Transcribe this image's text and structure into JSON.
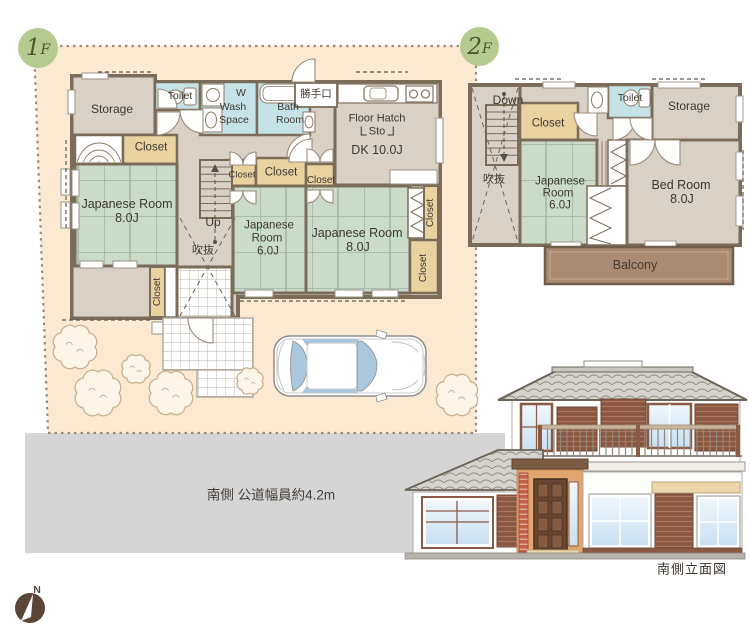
{
  "floor1": {
    "badge_num": "1",
    "badge_suffix": "F",
    "storage": "Storage",
    "toilet": "Toilet",
    "wash_l1": "W",
    "wash_l2": "Wash",
    "wash_l3": "Space",
    "bath_l1": "Bath",
    "bath_l2": "Room",
    "back_door": "勝手口",
    "floor_hatch_l1": "Floor Hatch",
    "floor_hatch_l2": "Sto",
    "dk": "DK 10.0J",
    "closet": "Closet",
    "jr8_l1": "Japanese Room",
    "jr8_l2": "8.0J",
    "jr6_l1": "Japanese",
    "jr6_l2": "Room",
    "jr6_l3": "6.0J",
    "up": "Up",
    "void": "吹抜"
  },
  "floor2": {
    "badge_num": "2",
    "badge_suffix": "F",
    "down": "Down",
    "closet": "Closet",
    "toilet": "Toilet",
    "storage": "Storage",
    "void": "吹抜",
    "jr6_l1": "Japanese",
    "jr6_l2": "Room",
    "jr6_l3": "6.0J",
    "bed_l1": "Bed Room",
    "bed_l2": "8.0J",
    "balcony": "Balcony"
  },
  "site": {
    "road_label": "南側 公道幅員約4.2m",
    "elevation_caption": "南側立面図",
    "compass_north": "N"
  },
  "colors": {
    "plot": "#fbe9d2",
    "road": "#d5d5d6",
    "floor": "#d9d1c6",
    "tatami": "#cadbca",
    "closet": "#e7d2a0",
    "wet": "#c5e3e6",
    "wall": "#7b6c5a",
    "balcony": "#ab8a72",
    "badge": "#b5ca8f",
    "wood_accent": "#8a5742"
  }
}
